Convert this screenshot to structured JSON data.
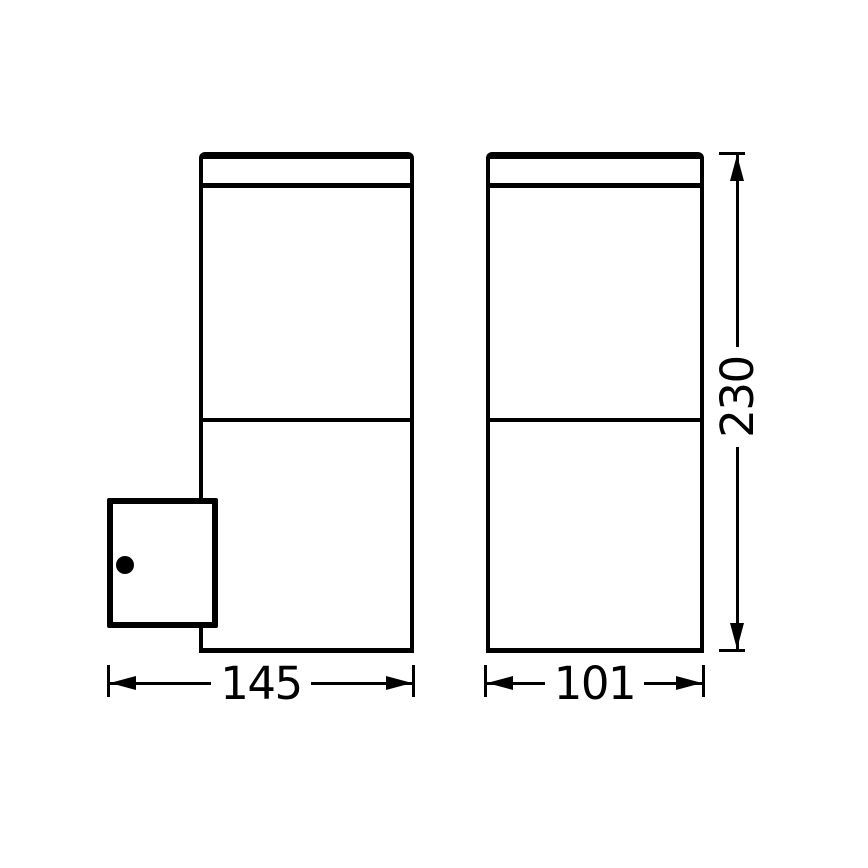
{
  "drawing": {
    "kind": "technical dimension drawing",
    "subject": "rectangular outdoor wall lantern, side view with wall-mount bracket (left) and front view (right)",
    "colors": {
      "line": "#000000",
      "background": "#ffffff"
    },
    "icons": {
      "screw_head": "filled-circle"
    },
    "dimensions": {
      "depth": {
        "label": "145",
        "orientation": "horizontal",
        "applies_to": "side view overall depth incl. bracket"
      },
      "width": {
        "label": "101",
        "orientation": "horizontal",
        "applies_to": "front view overall width"
      },
      "height": {
        "label": "230",
        "orientation": "vertical",
        "applies_to": "overall height"
      }
    }
  }
}
